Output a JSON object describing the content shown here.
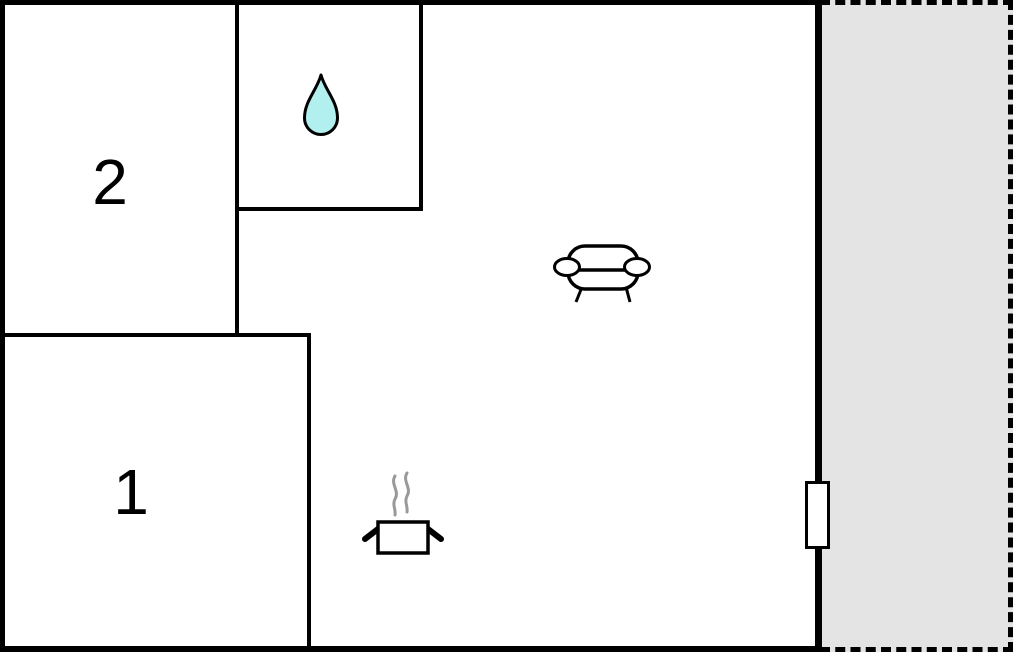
{
  "floor_plan": {
    "rooms": [
      {
        "name": "room-1",
        "label": "1"
      },
      {
        "name": "room-2",
        "label": "2"
      },
      {
        "name": "bathroom",
        "icon": "water-drop-icon"
      },
      {
        "name": "living-area",
        "icons": [
          "sofa-icon",
          "cooking-pot-icon"
        ]
      },
      {
        "name": "terrace",
        "outline": "dashed"
      }
    ],
    "fixtures": [
      {
        "name": "door",
        "location": "right-wall"
      }
    ],
    "colors": {
      "wall": "#000000",
      "room_fill": "#ffffff",
      "terrace_fill": "#e4e4e4",
      "water_drop_fill": "#b2f0f0",
      "steam": "#999999",
      "label_text": "#000000"
    }
  }
}
